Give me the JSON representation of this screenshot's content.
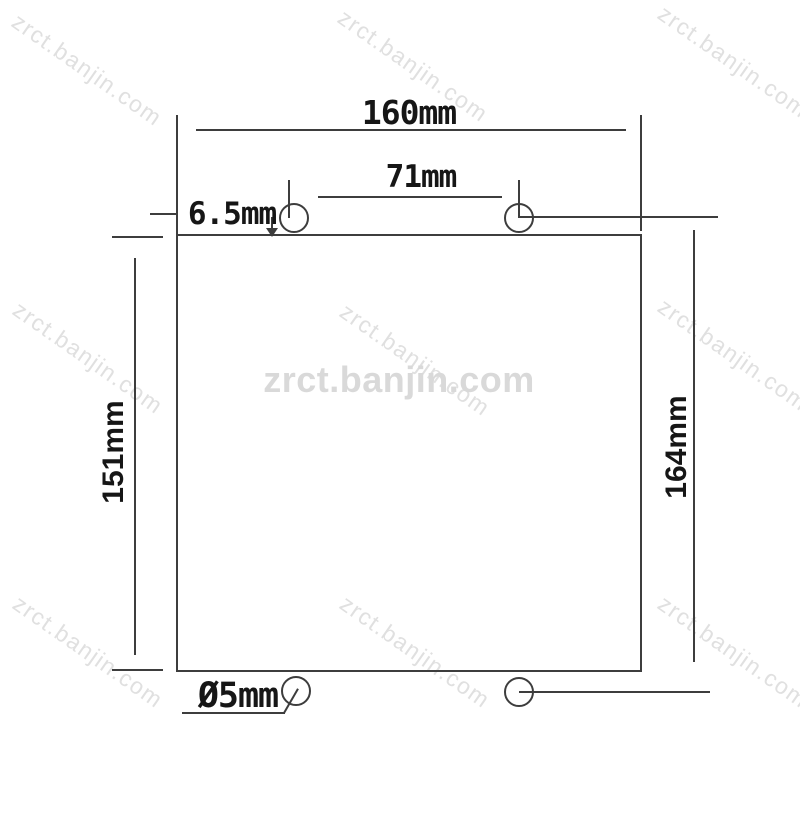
{
  "watermark": {
    "text": "zrct.banjin.com"
  },
  "dimensions": {
    "top_width": "160mm",
    "top_hole_spacing": "71mm",
    "top_hole_offset": "6.5mm",
    "left_height": "151mm",
    "right_height": "164mm",
    "hole_diameter": "Ø5mm"
  },
  "colors": {
    "background": "#ffffff",
    "line": "#3d3d3d",
    "text": "#161616",
    "watermark": "#e0e0e0",
    "watermark-center": "#d9d9d9"
  }
}
